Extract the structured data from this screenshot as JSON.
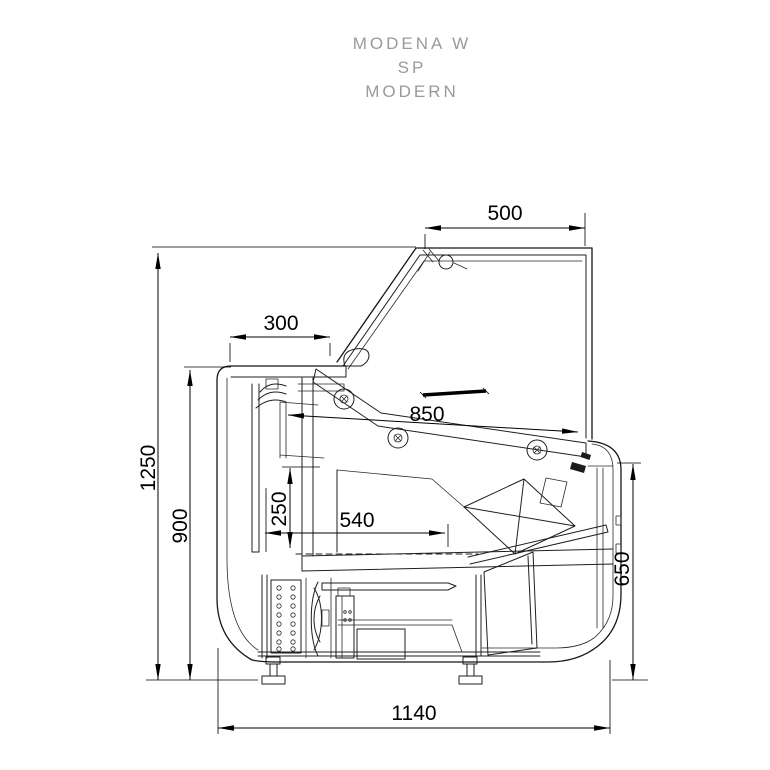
{
  "title": {
    "model": "MODENA W",
    "variant": "SP",
    "style_name": "MODERN"
  },
  "dimensions_mm": {
    "canopy_width": "500",
    "worktop_depth": "300",
    "shelf_rail_length": "850",
    "overall_height": "1250",
    "worktop_height": "900",
    "display_well_depth": "250",
    "display_well_width": "540",
    "front_height": "650",
    "base_depth": "1140"
  },
  "colors": {
    "background": "#ffffff",
    "drawing_line": "#1f1f1f",
    "title_text": "#9a9a9a",
    "dimension_text": "#000000"
  }
}
